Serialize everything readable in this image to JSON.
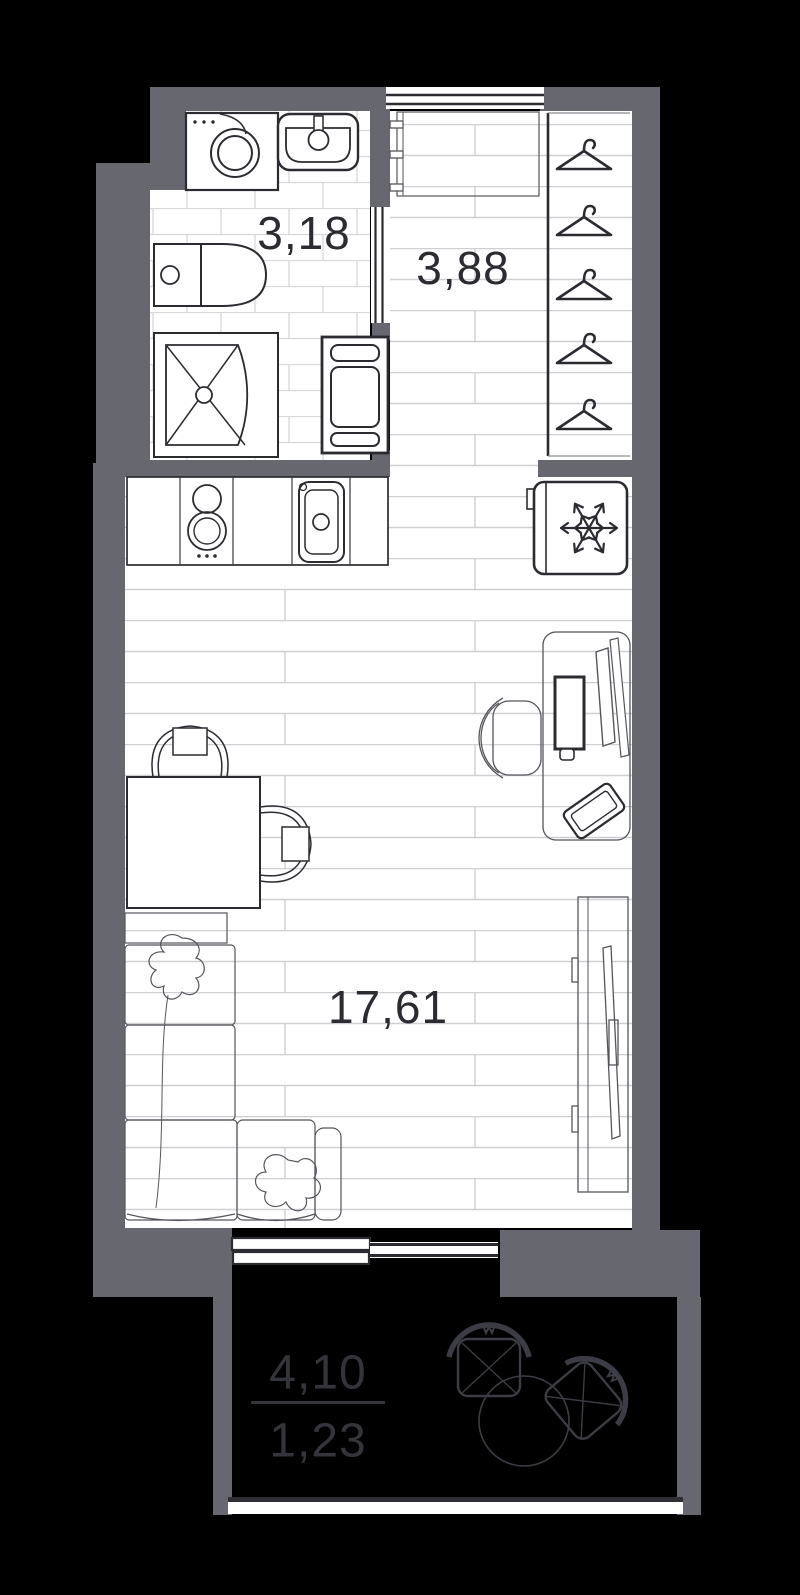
{
  "title": "Studio apartment floor plan",
  "rooms": {
    "bathroom": {
      "name": "bathroom",
      "area": "3,18"
    },
    "hallway": {
      "name": "hallway",
      "area": "3,88"
    },
    "living": {
      "name": "living-kitchen room",
      "area": "17,61"
    },
    "balcony": {
      "name": "balcony",
      "area_total": "4,10",
      "area_counted": "1,23"
    }
  },
  "furniture": {
    "bathroom": [
      "washing-machine",
      "wash-basin",
      "toilet",
      "shower-cabin",
      "towel-rail-cabinet"
    ],
    "hallway": [
      "entrance-door",
      "coat-rack",
      "wardrobe"
    ],
    "wardrobe_hanger_count": 5,
    "kitchen": [
      "counter",
      "hob-two-burners",
      "kitchen-sink",
      "fridge"
    ],
    "living": [
      "desk",
      "monitor",
      "keyboard",
      "mouse",
      "laptop",
      "office-chair",
      "dining-table",
      "dining-chair",
      "dining-chair",
      "corner-sofa",
      "pillow",
      "pillow",
      "tv-stand",
      "tv"
    ],
    "balcony": [
      "armchair",
      "round-table",
      "armchair"
    ]
  },
  "icons": {
    "hanger-icon": "clothes hanger triangle with hook",
    "snowflake-icon": "six-armed snowflake (fridge/freezer symbol)"
  },
  "colors": {
    "background": "#000000",
    "wall": "#67676f",
    "room_fill": "#ffffff",
    "outline_dark": "#2b2b31",
    "furniture_thin": "#55555c",
    "plank_line": "#cfcfd3",
    "tile_line": "#d8d8dc",
    "balcony_line": "#3c3c44",
    "balcony_text": "#34343b",
    "label_text": "#2b2b31"
  }
}
